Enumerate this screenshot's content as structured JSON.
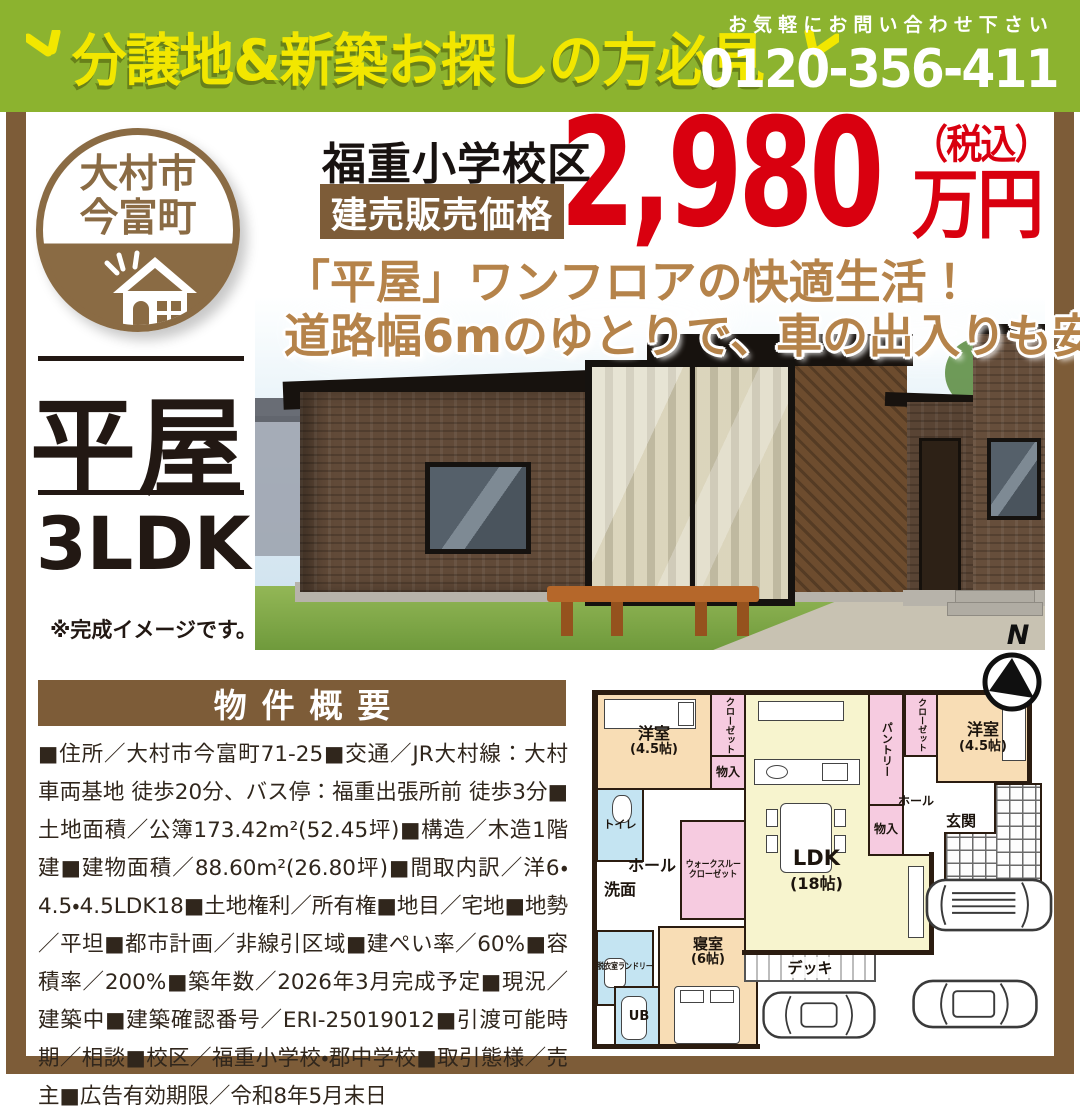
{
  "banner": {
    "headline": "分譲地&新築お探しの方必見",
    "contact_note": "お気軽にお問い合わせ下さい",
    "phone": "0120-356-411"
  },
  "badge": {
    "line1": "大村市",
    "line2": "今富町"
  },
  "price": {
    "school_zone": "福重小学校区",
    "label": "建売販売価格",
    "amount": "2,980",
    "unit": "万円",
    "tax_note": "（税込）"
  },
  "catchphrase": {
    "line1": "「平屋」ワンフロアの快適生活！",
    "line2": "道路幅6mのゆとりで、車の出入りも安心。"
  },
  "property": {
    "type": "平屋",
    "layout": "3LDK",
    "image_note": "※完成イメージです。"
  },
  "overview": {
    "title": "物件概要",
    "details": "■住所／大村市今富町71-25■交通／JR大村線：大村車両基地 徒歩20分、バス停：福重出張所前 徒歩3分■土地面積／公簿173.42m²(52.45坪)■構造／木造1階建■建物面積／88.60m²(26.80坪)■間取内訳／洋6・4.5・4.5LDK18■土地権利／所有権■地目／宅地■地勢／平坦■都市計画／非線引区域■建ぺい率／60%■容積率／200%■築年数／2026年3月完成予定■現況／建築中■建築確認番号／ERI-25019012■引渡可能時期／相談■校区／福重小学校・郡中学校■取引態様／売主■広告有効期限／令和8年5月末日"
  },
  "floorplan": {
    "compass": "N",
    "rooms": {
      "western1_name": "洋室",
      "western1_size": "(4.5帖)",
      "closet1": "クローゼット",
      "storage1": "物入",
      "toilet": "トイレ",
      "hall1": "ホール",
      "washroom": "洗面",
      "wtc_line1": "ウォークスルー",
      "wtc_line2": "クローゼット",
      "laundry": "脱衣室ランドリー",
      "ub": "UB",
      "bedroom_name": "寝室",
      "bedroom_size": "(6帖)",
      "ldk_name": "LDK",
      "ldk_size": "(18帖)",
      "pantry": "パントリー",
      "storage2": "物入",
      "closet2": "クローゼット",
      "western2_name": "洋室",
      "western2_size": "(4.5帖)",
      "hall2": "ホール",
      "entrance": "玄関",
      "deck": "デッキ"
    }
  },
  "colors": {
    "banner_green": "#8cb32f",
    "headline_yellow": "#f2e700",
    "brand_brown": "#7d5c38",
    "badge_brown": "#8a6b44",
    "price_red": "#d9000f",
    "catch_brown": "#b5834a",
    "room_beige": "#f8ddb5",
    "room_pink": "#f6cbe0",
    "room_yellow": "#f7f4ce",
    "room_blue": "#c4e4f2"
  }
}
